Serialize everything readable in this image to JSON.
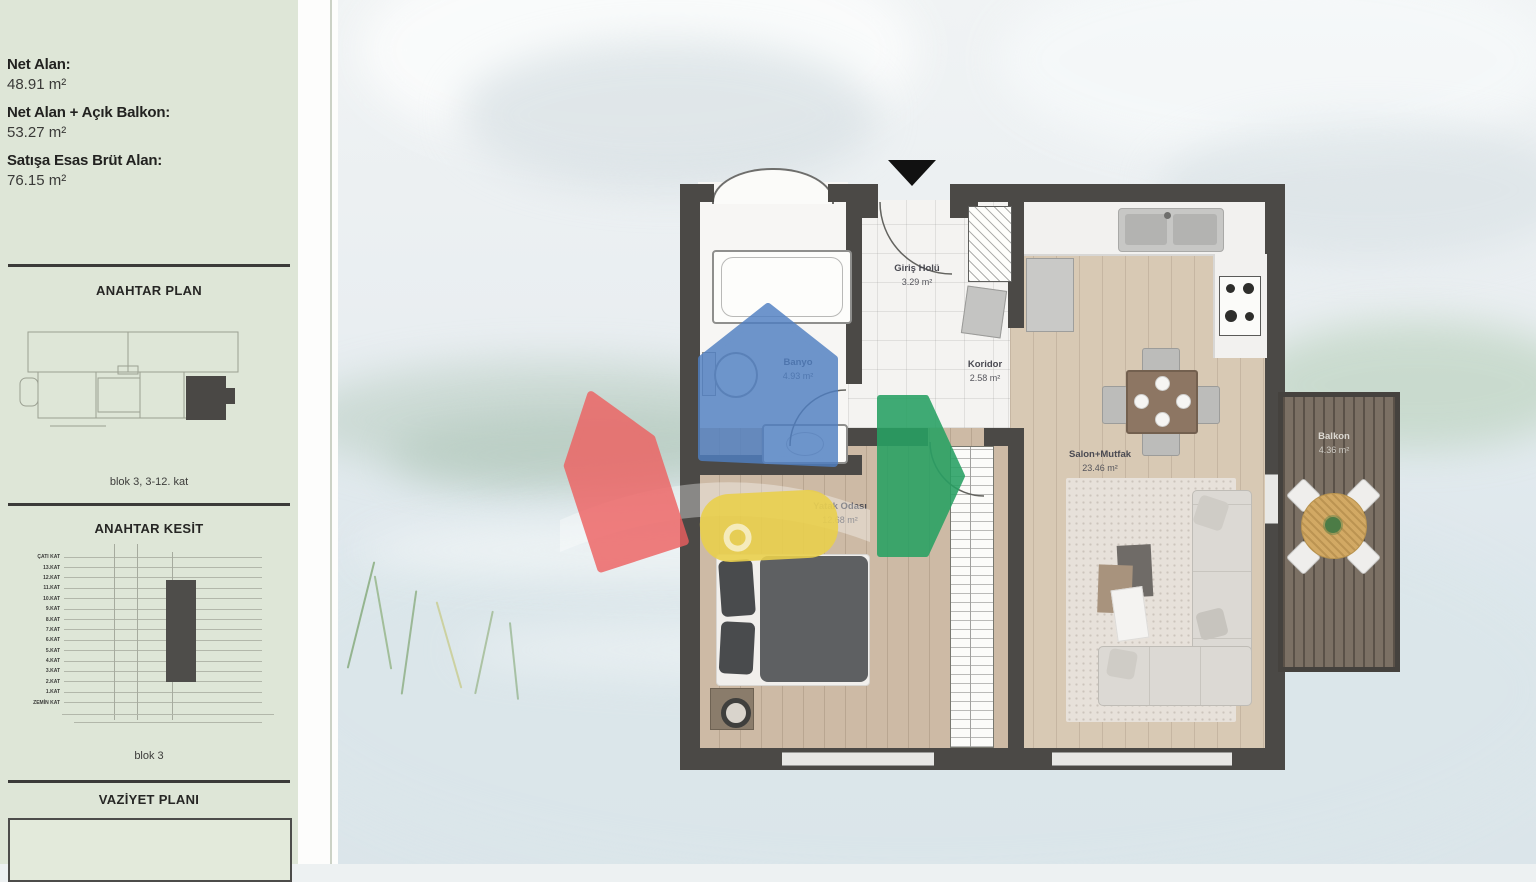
{
  "sidebar": {
    "area_info": [
      {
        "label": "Net Alan:",
        "value": "48.91 m²"
      },
      {
        "label": "Net Alan + Açık Balkon:",
        "value": "53.27 m²"
      },
      {
        "label": "Satışa Esas Brüt Alan:",
        "value": "76.15 m²"
      }
    ],
    "anahtar_plan": {
      "title": "ANAHTAR PLAN",
      "caption": "blok 3, 3-12. kat"
    },
    "anahtar_kesit": {
      "title": "ANAHTAR KESİT",
      "caption": "blok 3",
      "floors": [
        "ÇATI KAT",
        "13.KAT",
        "12.KAT",
        "11.KAT",
        "10.KAT",
        "9.KAT",
        "8.KAT",
        "7.KAT",
        "6.KAT",
        "5.KAT",
        "4.KAT",
        "3.KAT",
        "2.KAT",
        "1.KAT",
        "ZEMİN KAT"
      ]
    },
    "vaziyet_plani": {
      "title": "VAZİYET PLANI"
    }
  },
  "floorplan": {
    "rooms": {
      "giris_holu": {
        "name": "Giriş Holü",
        "area": "3.29 m²"
      },
      "banyo": {
        "name": "Banyo",
        "area": "4.93 m²"
      },
      "koridor": {
        "name": "Koridor",
        "area": "2.58 m²"
      },
      "yatak_odasi": {
        "name": "Yatak Odası",
        "area": "12.68 m²"
      },
      "salon_mutfak": {
        "name": "Salon+Mutfak",
        "area": "23.46 m²"
      },
      "balkon": {
        "name": "Balkon",
        "area": "4.36 m²"
      }
    },
    "wall_color": "#4b4946"
  },
  "watermark": {
    "colors": {
      "blue": "#4f7fc2",
      "red": "#ee5f5f",
      "yellow": "#e9cf4d",
      "green": "#27a163"
    }
  }
}
